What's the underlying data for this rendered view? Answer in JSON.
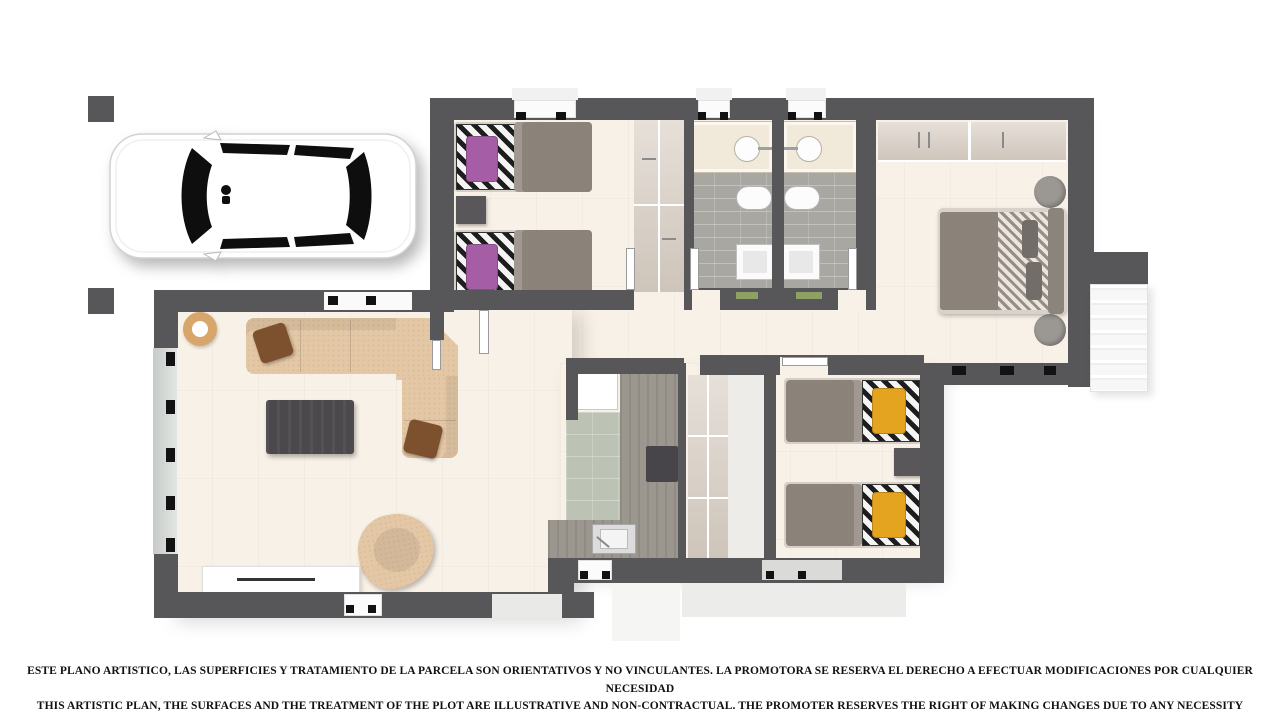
{
  "disclaimer": {
    "line_es": "ESTE PLANO ARTISTICO, LAS SUPERFICIES Y TRATAMIENTO DE LA PARCELA SON ORIENTATIVOS Y NO VINCULANTES. LA PROMOTORA SE RESERVA EL DERECHO A EFECTUAR MODIFICACIONES POR CUALQUIER NECESIDAD",
    "line_en": "THIS ARTISTIC PLAN, THE SURFACES AND THE TREATMENT OF THE PLOT ARE ILLUSTRATIVE AND NON-CONTRACTUAL. THE PROMOTER RESERVES THE RIGHT OF MAKING CHANGES DUE TO ANY NECESSITY"
  },
  "plan": {
    "type": "residential-floor-plan-top-view",
    "rooms": [
      "carport",
      "twin-bedroom-1",
      "bathroom-1",
      "bathroom-2",
      "master-bedroom",
      "hallway",
      "living-room",
      "kitchen",
      "corridor",
      "twin-bedroom-2",
      "exterior-staircase",
      "entry-porch"
    ],
    "furniture": [
      "car",
      "twin-bed-purple",
      "twin-bed-purple",
      "wardrobe",
      "vanity-sink",
      "toilet",
      "shower",
      "double-bed",
      "round-nightstand",
      "corner-sofa",
      "coffee-table",
      "armchair",
      "tv-console",
      "round-rug",
      "fridge",
      "kitchen-counter",
      "kitchen-sink",
      "cooktop",
      "twin-bed-yellow",
      "twin-bed-yellow",
      "nightstand",
      "hall-closet"
    ]
  },
  "colors": {
    "wall": "#57575a",
    "floor": "#f8f1e7",
    "bath_floor": "#a9a7a2",
    "vanity": "#f1e9da",
    "kitchen_floor": "#bcc3b4",
    "wood_counter": "#9b968e",
    "wardrobe": "#d9cfc4",
    "duvet": "#8b8279",
    "bed_purple": "#a55ea6",
    "bed_yellow": "#e5a41f",
    "sofa": "#e4c7a5",
    "cushion_brown": "#7d512e",
    "coffee_table": "#4b494b",
    "glass": "#ccd3cf",
    "stairs": "#f5f5f5",
    "mat_green": "#8fa065",
    "text": "#111111"
  }
}
